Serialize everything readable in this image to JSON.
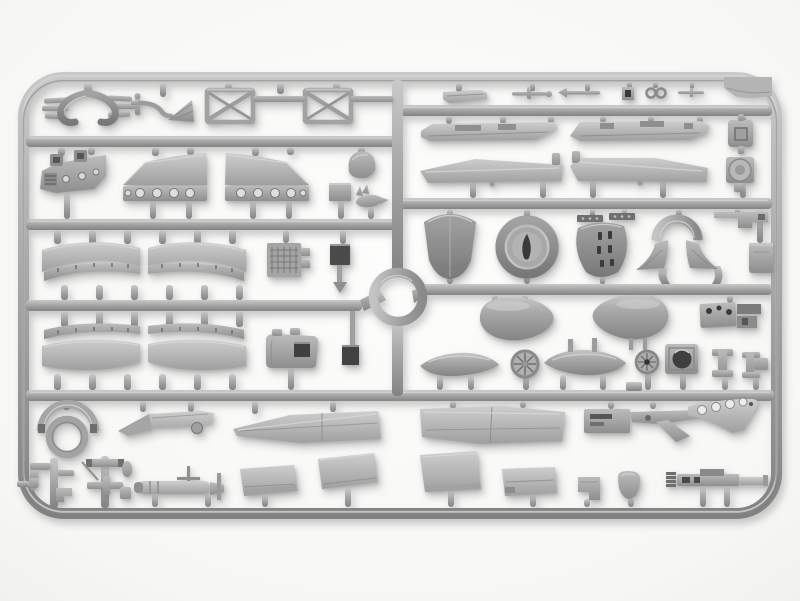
{
  "scene": {
    "description": "Photograph of a light-gray injection-molded polystyrene sprue (parts frame) from a scale aircraft model kit. The rectangular frame with rounded corners holds four rows of runners and a circular ring at center, with cowling pieces, fuselage strips, wing panels, drop tanks, spoked wheels, landing-gear truss frames, an exhaust collector, bombs and many small fittings attached by short gates.",
    "aria_label": "Gray plastic model kit sprue with aircraft parts on a white background",
    "colors": {
      "background": "#f7f7f5",
      "plastic_base": "#a8a8a8",
      "plastic_highlight": "#cdcdcd",
      "plastic_shadow": "#808080",
      "recess_dark": "#3a3a3a"
    }
  },
  "sprue": {
    "frame_rows": 4,
    "center_ring": "circular runner ring at image center",
    "parts_inventory": {
      "row1_left": [
        "exhaust-collector",
        "pipe-funnel-bracket",
        "landing-gear-frame-left",
        "landing-gear-frame-right"
      ],
      "row1_right": [
        "flat-strip",
        "control-rod-a",
        "control-rod-b",
        "small-square-fitting",
        "twin-eyelet-fitting",
        "control-rod-c",
        "corner-tab"
      ],
      "row2_left": [
        "cockpit-sidewall",
        "wing-fairing-left",
        "wing-fairing-right",
        "headrest-fairing",
        "access-plate",
        "small-finned-bomb"
      ],
      "row2_right": [
        "fuselage-strip-left",
        "fuselage-strip-right",
        "square-block-with-hole",
        "tapered-panel-left",
        "tapered-panel-right",
        "cylinder-drum"
      ],
      "row3_left": [
        "leading-edge-slat-cluster-left",
        "leading-edge-slat-cluster-right",
        "radiator-grid",
        "dark-plate-with-pin"
      ],
      "row3_right": [
        "engine-cowling-bell",
        "cowl-front-ring",
        "curved-plate-with-slots",
        "hinge-strip-a",
        "hinge-strip-b",
        "arch-with-fin-fairings",
        "stepped-bracket",
        "block-part"
      ],
      "row4_left": [
        "slat-cluster-lower-left",
        "slat-cluster-lower-right",
        "cowl-front-small",
        "dark-flag-pin"
      ],
      "row4_right": [
        "teardrop-tank-left",
        "teardrop-tank-right",
        "instrument-panel-combo",
        "slim-tank-left",
        "spoked-wheel-large",
        "slim-tank-right",
        "spoked-wheel-small",
        "box-with-round-hole",
        "clamp-fitting-a",
        "clamp-fitting-b"
      ],
      "row5": [
        "open-cowl-ring",
        "bomb-rack-arm",
        "wing-panel-left",
        "wing-panel-right",
        "bracket-assembly",
        "wing-root-fairing"
      ],
      "row6": [
        "small-parts-cluster-a",
        "small-parts-cluster-b",
        "torpedo-body",
        "trapezoid-panel-a",
        "windscreen-panel",
        "trapezoid-panel-b",
        "trapezoid-panel-c",
        "step-fitting",
        "oval-pad",
        "gun-mount-rail"
      ]
    }
  }
}
